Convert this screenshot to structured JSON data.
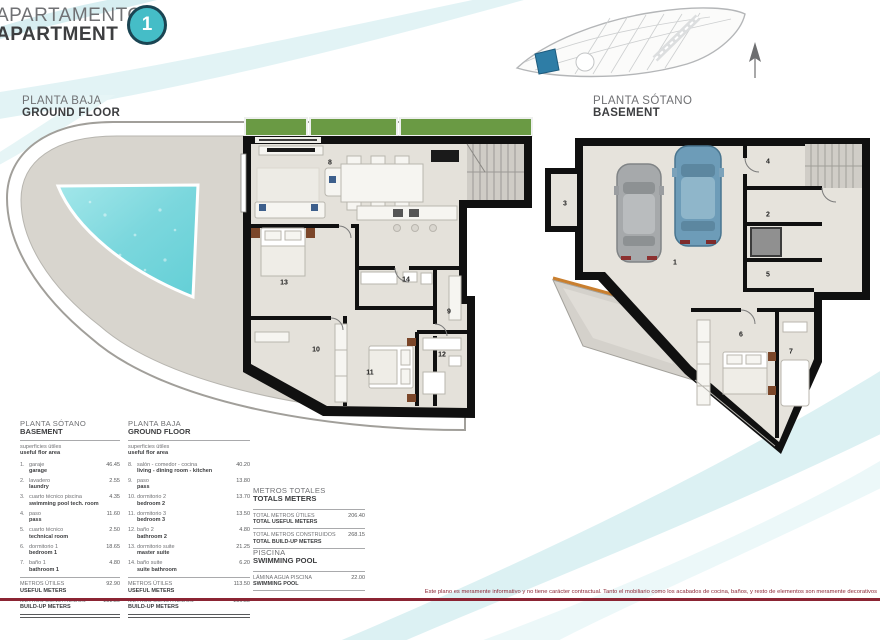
{
  "header": {
    "title_es": "APARTAMENTO",
    "title_en": "APARTMENT",
    "unit_number": "1"
  },
  "plan_titles": {
    "ground": {
      "es": "PLANTA BAJA",
      "en": "GROUND FLOOR"
    },
    "basement": {
      "es": "PLANTA SÓTANO",
      "en": "BASEMENT"
    }
  },
  "ground_rooms": [
    {
      "num": "8",
      "x": 325,
      "y": 53
    },
    {
      "num": "9",
      "x": 444,
      "y": 202
    },
    {
      "num": "10",
      "x": 311,
      "y": 240
    },
    {
      "num": "11",
      "x": 365,
      "y": 263
    },
    {
      "num": "12",
      "x": 437,
      "y": 245
    },
    {
      "num": "13",
      "x": 279,
      "y": 173
    },
    {
      "num": "14",
      "x": 401,
      "y": 170
    }
  ],
  "basement_rooms": [
    {
      "num": "1",
      "x": 130,
      "y": 133
    },
    {
      "num": "2",
      "x": 223,
      "y": 85
    },
    {
      "num": "3",
      "x": 20,
      "y": 74
    },
    {
      "num": "4",
      "x": 223,
      "y": 32
    },
    {
      "num": "5",
      "x": 223,
      "y": 145
    },
    {
      "num": "6",
      "x": 196,
      "y": 205
    },
    {
      "num": "7",
      "x": 246,
      "y": 222
    }
  ],
  "tables": {
    "basement": {
      "title_es": "PLANTA SÓTANO",
      "title_en": "BASEMENT",
      "subtitle_es": "superficies útiles",
      "subtitle_en": "useful flor area",
      "rows": [
        {
          "num": "1.",
          "es": "garaje",
          "en": "garage",
          "value": "46.45"
        },
        {
          "num": "2.",
          "es": "lavadero",
          "en": "laundry",
          "value": "2.55"
        },
        {
          "num": "3.",
          "es": "cuarto técnico piscina",
          "en": "swimming pool tech. room",
          "value": "4.35"
        },
        {
          "num": "4.",
          "es": "paso",
          "en": "pass",
          "value": "11.60"
        },
        {
          "num": "5.",
          "es": "cuarto técnico",
          "en": "technical room",
          "value": "2.50"
        },
        {
          "num": "6.",
          "es": "dormitorio 1",
          "en": "bedroom 1",
          "value": "18.65"
        },
        {
          "num": "7.",
          "es": "baño 1",
          "en": "bathroom 1",
          "value": "4.80"
        }
      ],
      "totals": [
        {
          "es": "METROS ÚTILES",
          "en": "USEFUL METERS",
          "value": "92.90"
        },
        {
          "es": "METROS CONSTRUIDOS",
          "en": "BUILD-UP METERS",
          "value": "131.30"
        }
      ]
    },
    "ground": {
      "title_es": "PLANTA BAJA",
      "title_en": "GROUND FLOOR",
      "subtitle_es": "superficies útiles",
      "subtitle_en": "useful flor area",
      "rows": [
        {
          "num": "8.",
          "es": "salón - comedor - cocina",
          "en": "living - dining room - kitchen",
          "value": "40.20"
        },
        {
          "num": "9.",
          "es": "paso",
          "en": "pass",
          "value": "13.80"
        },
        {
          "num": "10.",
          "es": "dormitorio 2",
          "en": "bedroom 2",
          "value": "13.70"
        },
        {
          "num": "11.",
          "es": "dormitorio 3",
          "en": "bedroom 3",
          "value": "13.50"
        },
        {
          "num": "12.",
          "es": "baño 2",
          "en": "bathroom 2",
          "value": "4.80"
        },
        {
          "num": "13.",
          "es": "dormitorio suite",
          "en": "master suite",
          "value": "21.25"
        },
        {
          "num": "14.",
          "es": "baño suite",
          "en": "suite bathroom",
          "value": "6.20"
        }
      ],
      "totals": [
        {
          "es": "METROS ÚTILES",
          "en": "USEFUL METERS",
          "value": "113.50"
        },
        {
          "es": "METROS CONSTRUIDOS",
          "en": "BUILD-UP METERS",
          "value": "136.85"
        }
      ]
    }
  },
  "totals_panel": {
    "title_es": "METROS TOTALES",
    "title_en": "TOTALS METERS",
    "rows": [
      {
        "es": "TOTAL METROS ÚTILES",
        "en": "TOTAL USEFUL METERS",
        "value": "206.40"
      },
      {
        "es": "TOTAL METROS CONSTRUIDOS",
        "en": "TOTAL BUILD-UP METERS",
        "value": "268.15"
      }
    ]
  },
  "pool_panel": {
    "title_es": "PISCINA",
    "title_en": "SWIMMING POOL",
    "rows": [
      {
        "es": "LÁMINA AGUA PISCINA",
        "en": "SWIMMING POOL",
        "value": "22.00"
      }
    ]
  },
  "disclaimer": "Este plano es meramente informativo y no tiene carácter contractual. Tanto el mobiliario como los acabados de cocina, baños, y resto de elementos son meramente decorativos",
  "colors": {
    "accent_teal": "#45bdc7",
    "maroon": "#8b2433",
    "pool_water": "#7fd8de",
    "planter_green": "#6a9a44",
    "unit_highlight_blue": "#2e7da6",
    "wall_black": "#101010"
  }
}
